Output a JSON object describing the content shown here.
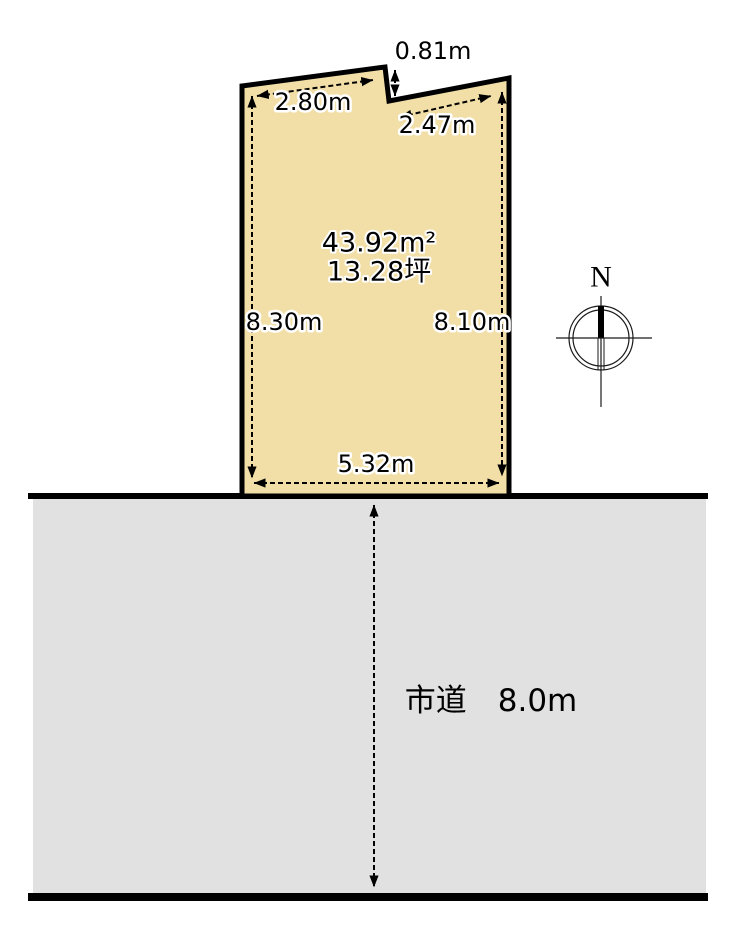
{
  "site_plan": {
    "parcel": {
      "fill_color": "#F2DFA8",
      "outline_color": "#000000",
      "area_sqm": "43.92m²",
      "area_tsubo": "13.28坪",
      "dimensions": {
        "top_left_edge": "2.80m",
        "notch_depth": "0.81m",
        "top_right_edge": "2.47m",
        "left_edge": "8.30m",
        "right_edge": "8.10m",
        "bottom_edge": "5.32m"
      }
    },
    "road": {
      "label": "市道　8.0m",
      "fill_color": "#E1E1E1",
      "edge_color": "#000000"
    },
    "compass": {
      "north_label": "N"
    }
  }
}
